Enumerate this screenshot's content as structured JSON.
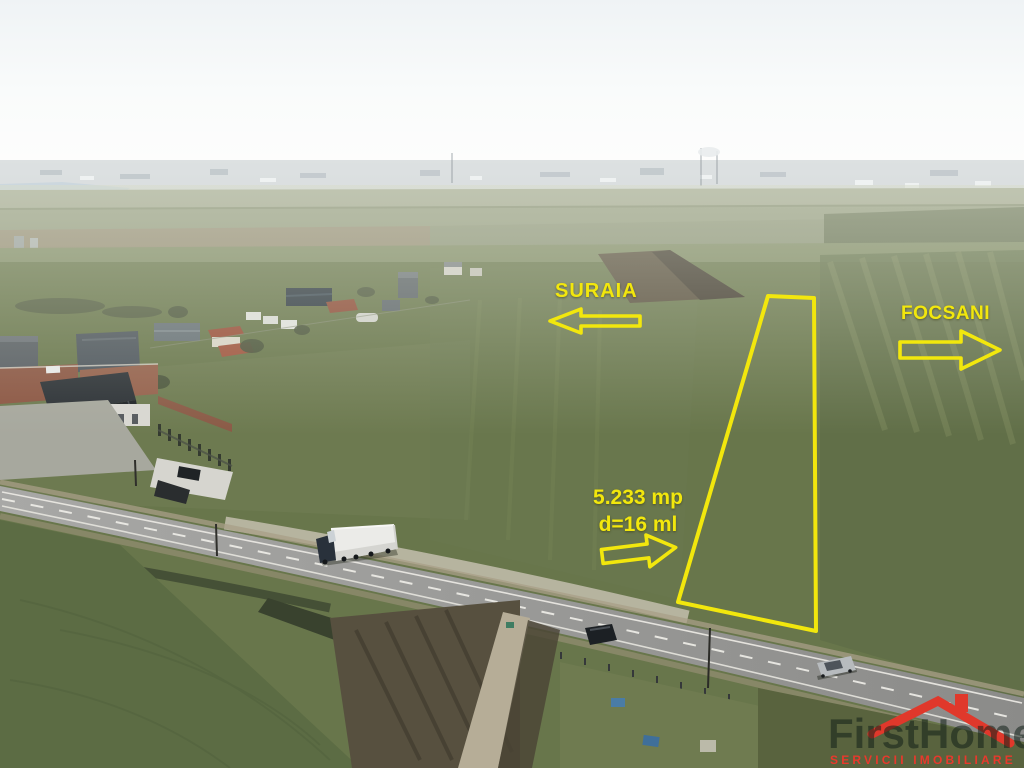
{
  "photo": {
    "direction_labels": [
      {
        "id": "suraia",
        "label": "SURAIA",
        "arrow": "left"
      },
      {
        "id": "focsani",
        "label": "FOCSANI",
        "arrow": "right"
      }
    ],
    "parcel": {
      "area_label": "5.233 mp",
      "frontage_label": "d=16 ml",
      "arrow": "right",
      "outline_color": "#f2e70d"
    }
  },
  "watermark": {
    "brand": "FirstHome",
    "tagline": "SERVICII IMOBILIARE"
  },
  "colors": {
    "annotation_yellow": "#f2e70d",
    "logo_red": "#e0382b"
  }
}
